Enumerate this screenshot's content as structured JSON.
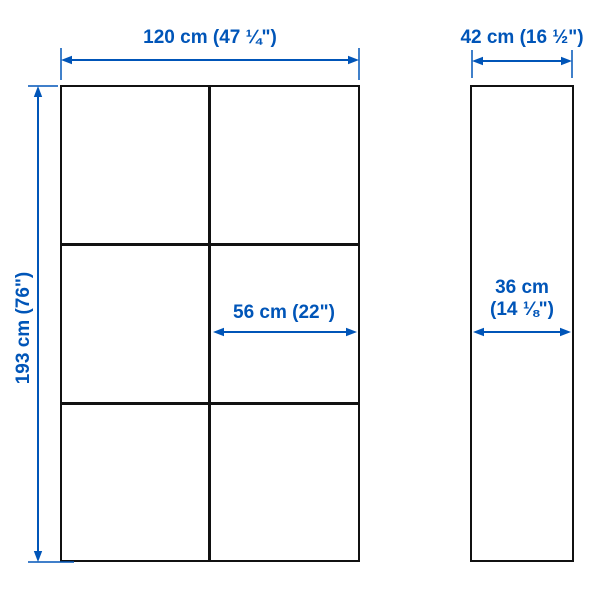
{
  "diagram": {
    "type": "furniture-dimension-diagram",
    "views": [
      "front",
      "side"
    ]
  },
  "front_view": {
    "width_label": "120 cm (47 ¼\")",
    "height_label": "193 cm (76\")",
    "inner_width_label": "56 cm (22\")",
    "grid": {
      "columns": 2,
      "rows": 3
    }
  },
  "side_view": {
    "depth_label": "42 cm (16 ½\")",
    "inner_depth_label_line1": "36 cm",
    "inner_depth_label_line2": "(14 ⅛\")"
  },
  "colors": {
    "dimension_accent": "#0055b8",
    "outline": "#111111",
    "background": "#ffffff"
  }
}
